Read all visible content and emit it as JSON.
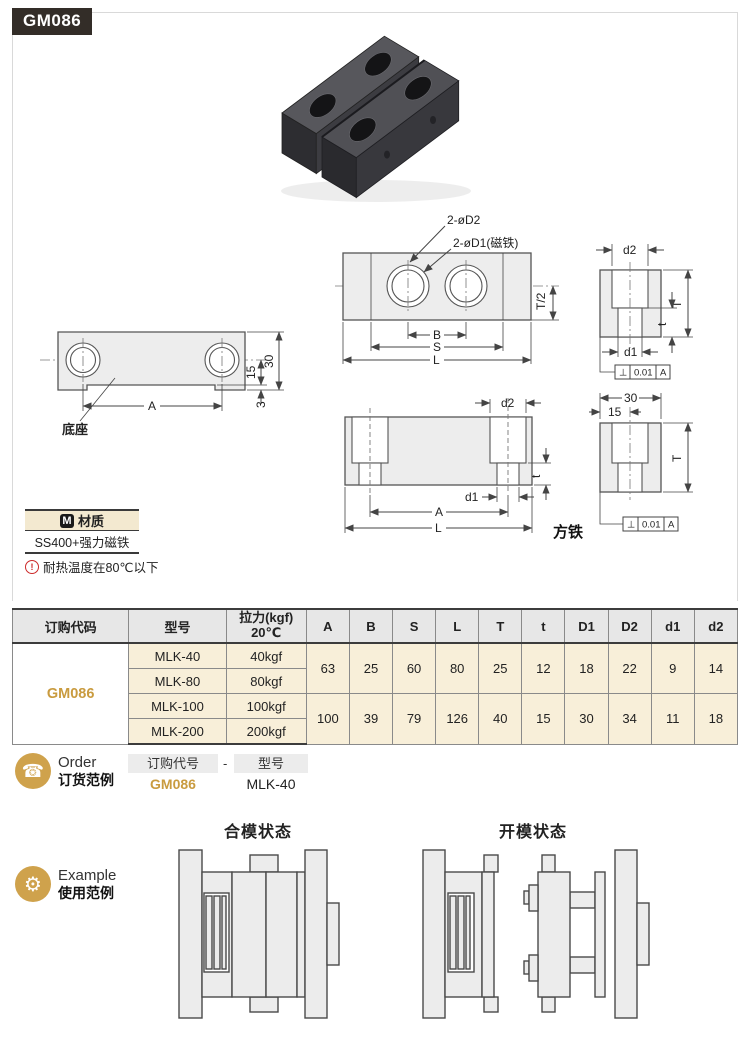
{
  "page": {
    "code": "GM086"
  },
  "colors": {
    "accent_gold": "#cfa24c",
    "badge_bg": "#332d28",
    "table_beige": "#f8efd9",
    "warn_red": "#cc2a2a"
  },
  "icons": {
    "order_phone": "☎",
    "example_gear": "⚙",
    "material_m": "M",
    "warning": "!"
  },
  "drawings": {
    "base": {
      "label": "底座",
      "a": "A",
      "h30": "30",
      "h15": "15",
      "h3": "3"
    },
    "top": {
      "callout_d2": "2-øD2",
      "callout_d1": "2-øD1(磁铁)",
      "b": "B",
      "s": "S",
      "l": "L",
      "t2": "T/2"
    },
    "side_top": {
      "d2": "d2",
      "T": "T",
      "t": "t",
      "d1": "d1",
      "fcf_sym": "⊥",
      "fcf_val": "0.01",
      "fcf_ref": "A"
    },
    "front": {
      "d2": "d2",
      "t": "t",
      "d1": "d1",
      "a": "A",
      "l": "L"
    },
    "side_bottom": {
      "w30": "30",
      "w15": "15",
      "T": "T",
      "fcf_sym": "⊥",
      "fcf_val": "0.01",
      "fcf_ref": "A",
      "label": "方铁"
    }
  },
  "material": {
    "title": "材质",
    "value": "SS400+强力磁铁",
    "note": "耐热温度在80℃以下"
  },
  "table": {
    "col_code": "订购代码",
    "col_model": "型号",
    "col_force_line1": "拉力(kgf)",
    "col_force_line2": "20℃",
    "dim_headers": [
      "A",
      "B",
      "S",
      "L",
      "T",
      "t",
      "D1",
      "D2",
      "d1",
      "d2"
    ],
    "code": "GM086",
    "groups": [
      {
        "rows": [
          {
            "model": "MLK-40",
            "force": "40kgf"
          },
          {
            "model": "MLK-80",
            "force": "80kgf"
          }
        ],
        "dims": [
          "63",
          "25",
          "60",
          "80",
          "25",
          "12",
          "18",
          "22",
          "9",
          "14"
        ]
      },
      {
        "rows": [
          {
            "model": "MLK-100",
            "force": "100kgf"
          },
          {
            "model": "MLK-200",
            "force": "200kgf"
          }
        ],
        "dims": [
          "100",
          "39",
          "79",
          "126",
          "40",
          "15",
          "30",
          "34",
          "11",
          "18"
        ]
      }
    ]
  },
  "order": {
    "en": "Order",
    "zh": "订货范例",
    "box_code": "订购代号",
    "separator": "-",
    "box_model": "型号",
    "code": "GM086",
    "model": "MLK-40"
  },
  "example": {
    "en": "Example",
    "zh": "使用范例",
    "closed": "合模状态",
    "open": "开模状态"
  }
}
